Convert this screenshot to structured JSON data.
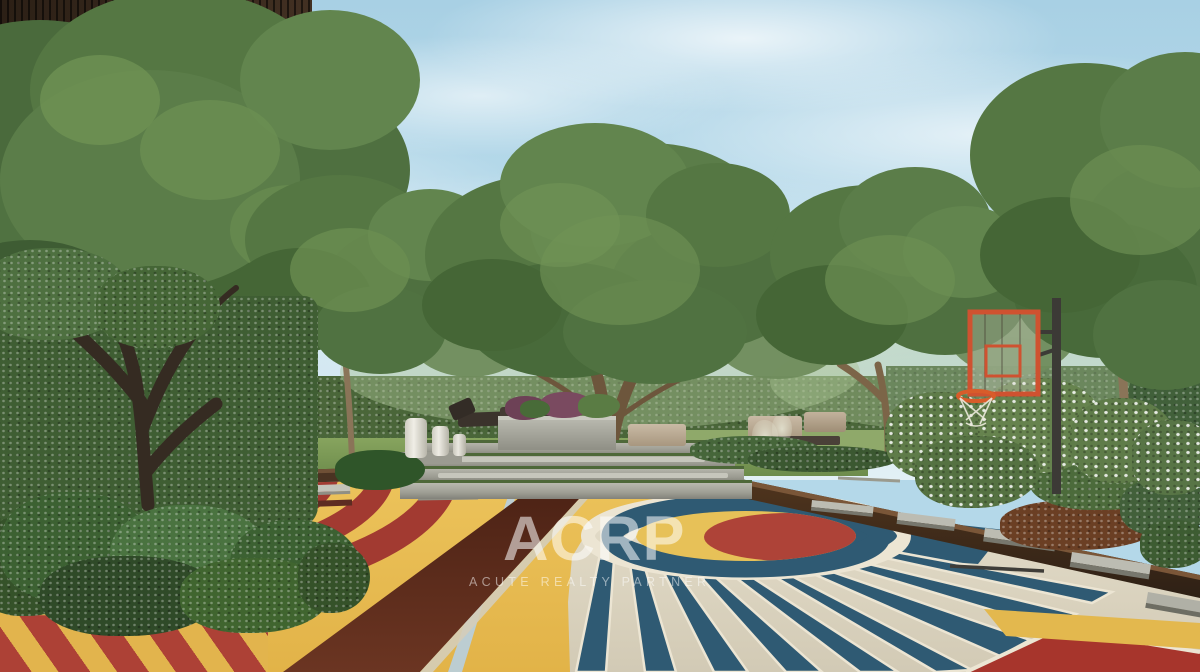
{
  "watermark": {
    "logo": "ACRP",
    "tagline": "ACUTE REALTY PARTNER"
  },
  "palette": {
    "sky_blue": "#b4d8e9",
    "foliage_green": "#557743",
    "hedge_green": "#44603a",
    "building_brown": "#33241a",
    "court_yellow": "#e8bc52",
    "court_cream": "#ddd6c2",
    "court_teal": "#2f5a73",
    "court_red": "#ae4338",
    "court_maroon": "#5a281c",
    "hoop_orange": "#cf5230",
    "concrete_gray": "#a9a9a0"
  }
}
